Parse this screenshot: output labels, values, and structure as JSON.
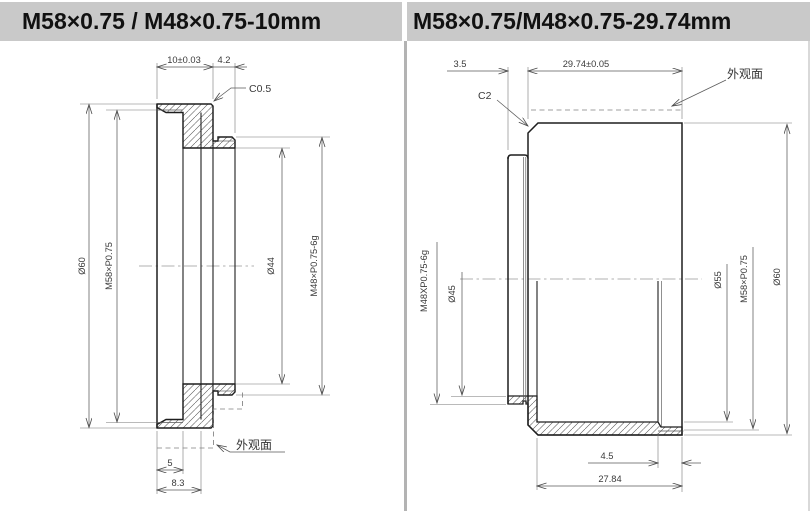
{
  "colors": {
    "header_bg": "#c9c9c9",
    "line": "#1e1e1e",
    "dim_line": "#5a5a5a"
  },
  "panels": [
    {
      "title": "M58×0.75 / M48×0.75-10mm",
      "dims": {
        "flange_width": "10±0.03",
        "stub_width": "4.2",
        "chamfer": "C0.5",
        "outer": "Ø60",
        "thread_internal": "M58×P0.75",
        "bore": "Ø44",
        "thread_external": "M48×P0.75-6g",
        "thread_depth": "5",
        "runout_depth": "8.3",
        "surface": "外观面"
      }
    },
    {
      "title": "M58×0.75/M48×0.75-29.74mm",
      "dims": {
        "stub_len": "3.5",
        "body_len": "29.74±0.05",
        "chamfer": "C2",
        "thread_external": "M48XP0.75-6g",
        "bore_small": "Ø45",
        "bore_large": "Ø55",
        "thread_internal": "M58×P0.75",
        "outer": "Ø60",
        "thread_depth": "4.5",
        "cavity_depth": "27.84",
        "surface": "外观面"
      }
    }
  ]
}
